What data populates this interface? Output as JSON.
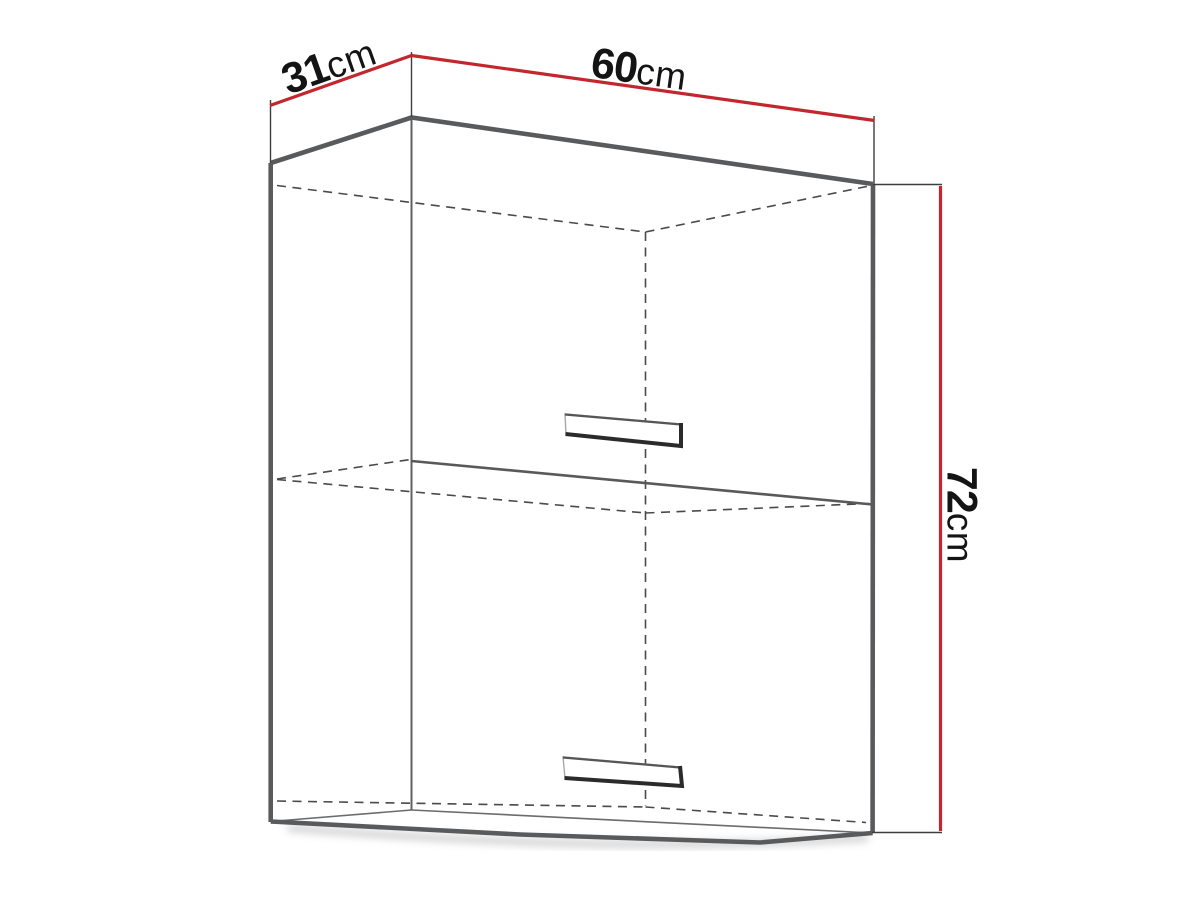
{
  "dimensions": {
    "depth": {
      "value": "31",
      "unit": "cm"
    },
    "width": {
      "value": "60",
      "unit": "cm"
    },
    "height": {
      "value": "72",
      "unit": "cm"
    }
  },
  "colors": {
    "dimension_line": "#c1272d",
    "outline": "#595a5c",
    "hidden_line": "#4a4a4a",
    "text": "#141414"
  }
}
